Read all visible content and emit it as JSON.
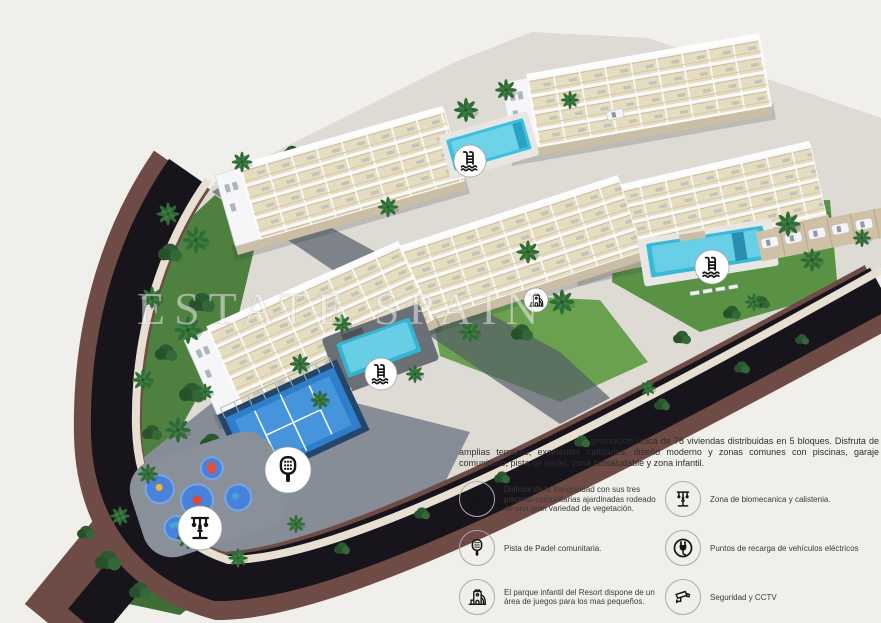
{
  "watermark": "ESTATE SPAIN",
  "description": {
    "text": "promoción única de 78 viviendas distribuidas en 5 bloques. Disfruta de amplias terrazas, excelentes calidades, diseño moderno y zonas comunes con piscinas, garaje comunitario, pista de pádel, zona biosaludable y zona infantil."
  },
  "legend": {
    "items": [
      {
        "icon": "pool-ladder-icon",
        "label": "Disfrute de la tranquilidad con sus tres piscinas comunitarias ajardinadas rodeado de una gran variedad de vegetación."
      },
      {
        "icon": "biomechanics-machine-icon",
        "label": "Zona de biomecanica y calistenia."
      },
      {
        "icon": "padel-racket-icon",
        "label": "Pista de Padel comunitaria."
      },
      {
        "icon": "ev-plug-icon",
        "label": "Puntos de recarga de vehículos eléctricos"
      },
      {
        "icon": "playground-castle-icon",
        "label": "El parque infantil del Resort dispone de un área de juegos para los mas pequeños."
      },
      {
        "icon": "cctv-camera-icon",
        "label": "Seguridad y CCTV"
      }
    ]
  },
  "site_plan": {
    "badges": [
      "pool-ladder-icon",
      "pool-ladder-icon",
      "pool-ladder-icon",
      "padel-racket-icon",
      "biomechanics-machine-icon",
      "playground-castle-icon"
    ],
    "colors": {
      "background": "#f0efec",
      "pool_water": "#3cc0dd",
      "padel_court": "#2e7ecb",
      "road_asphalt": "#15121a",
      "road_wall": "#6e4c45",
      "sidewalk": "#e7e0d2",
      "grass": "#5a9245",
      "building_wall": "#f6f6f8",
      "terrace": "#e6dcc0"
    }
  }
}
